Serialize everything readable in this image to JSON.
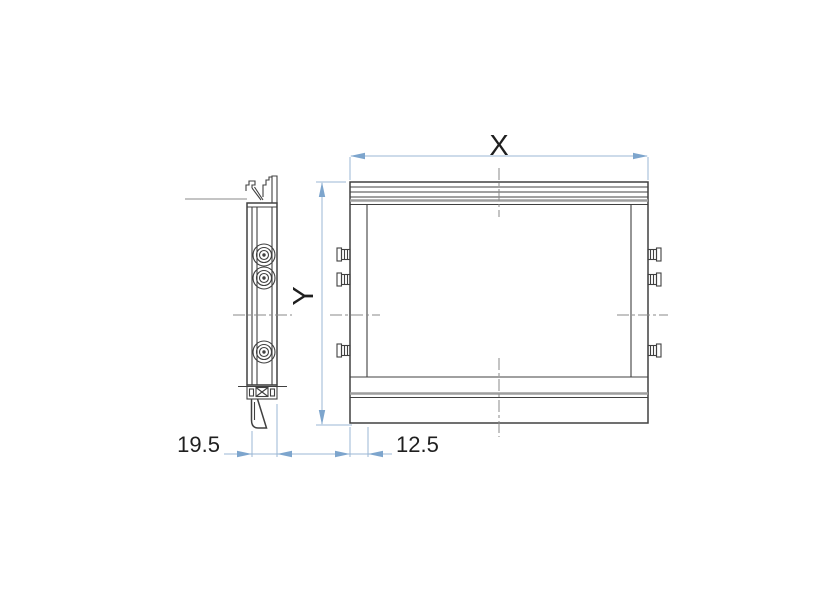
{
  "drawing": {
    "type": "technical-drawing",
    "views": {
      "side_view": "profile-section",
      "front_view": "front-elevation"
    }
  },
  "dimensions": {
    "x_label": "X",
    "y_label": "Y",
    "depth_label": "19.5",
    "border_label": "12.5"
  },
  "colors": {
    "drawing_line": "#404040",
    "accent_gray": "#9e9e9e",
    "dimension_blue": "#7da5cd",
    "dimension_line_blue": "#9bb7d4",
    "centerline_gray": "#8a8a8a",
    "label_text": "#1f1f1f",
    "background": "#ffffff"
  }
}
